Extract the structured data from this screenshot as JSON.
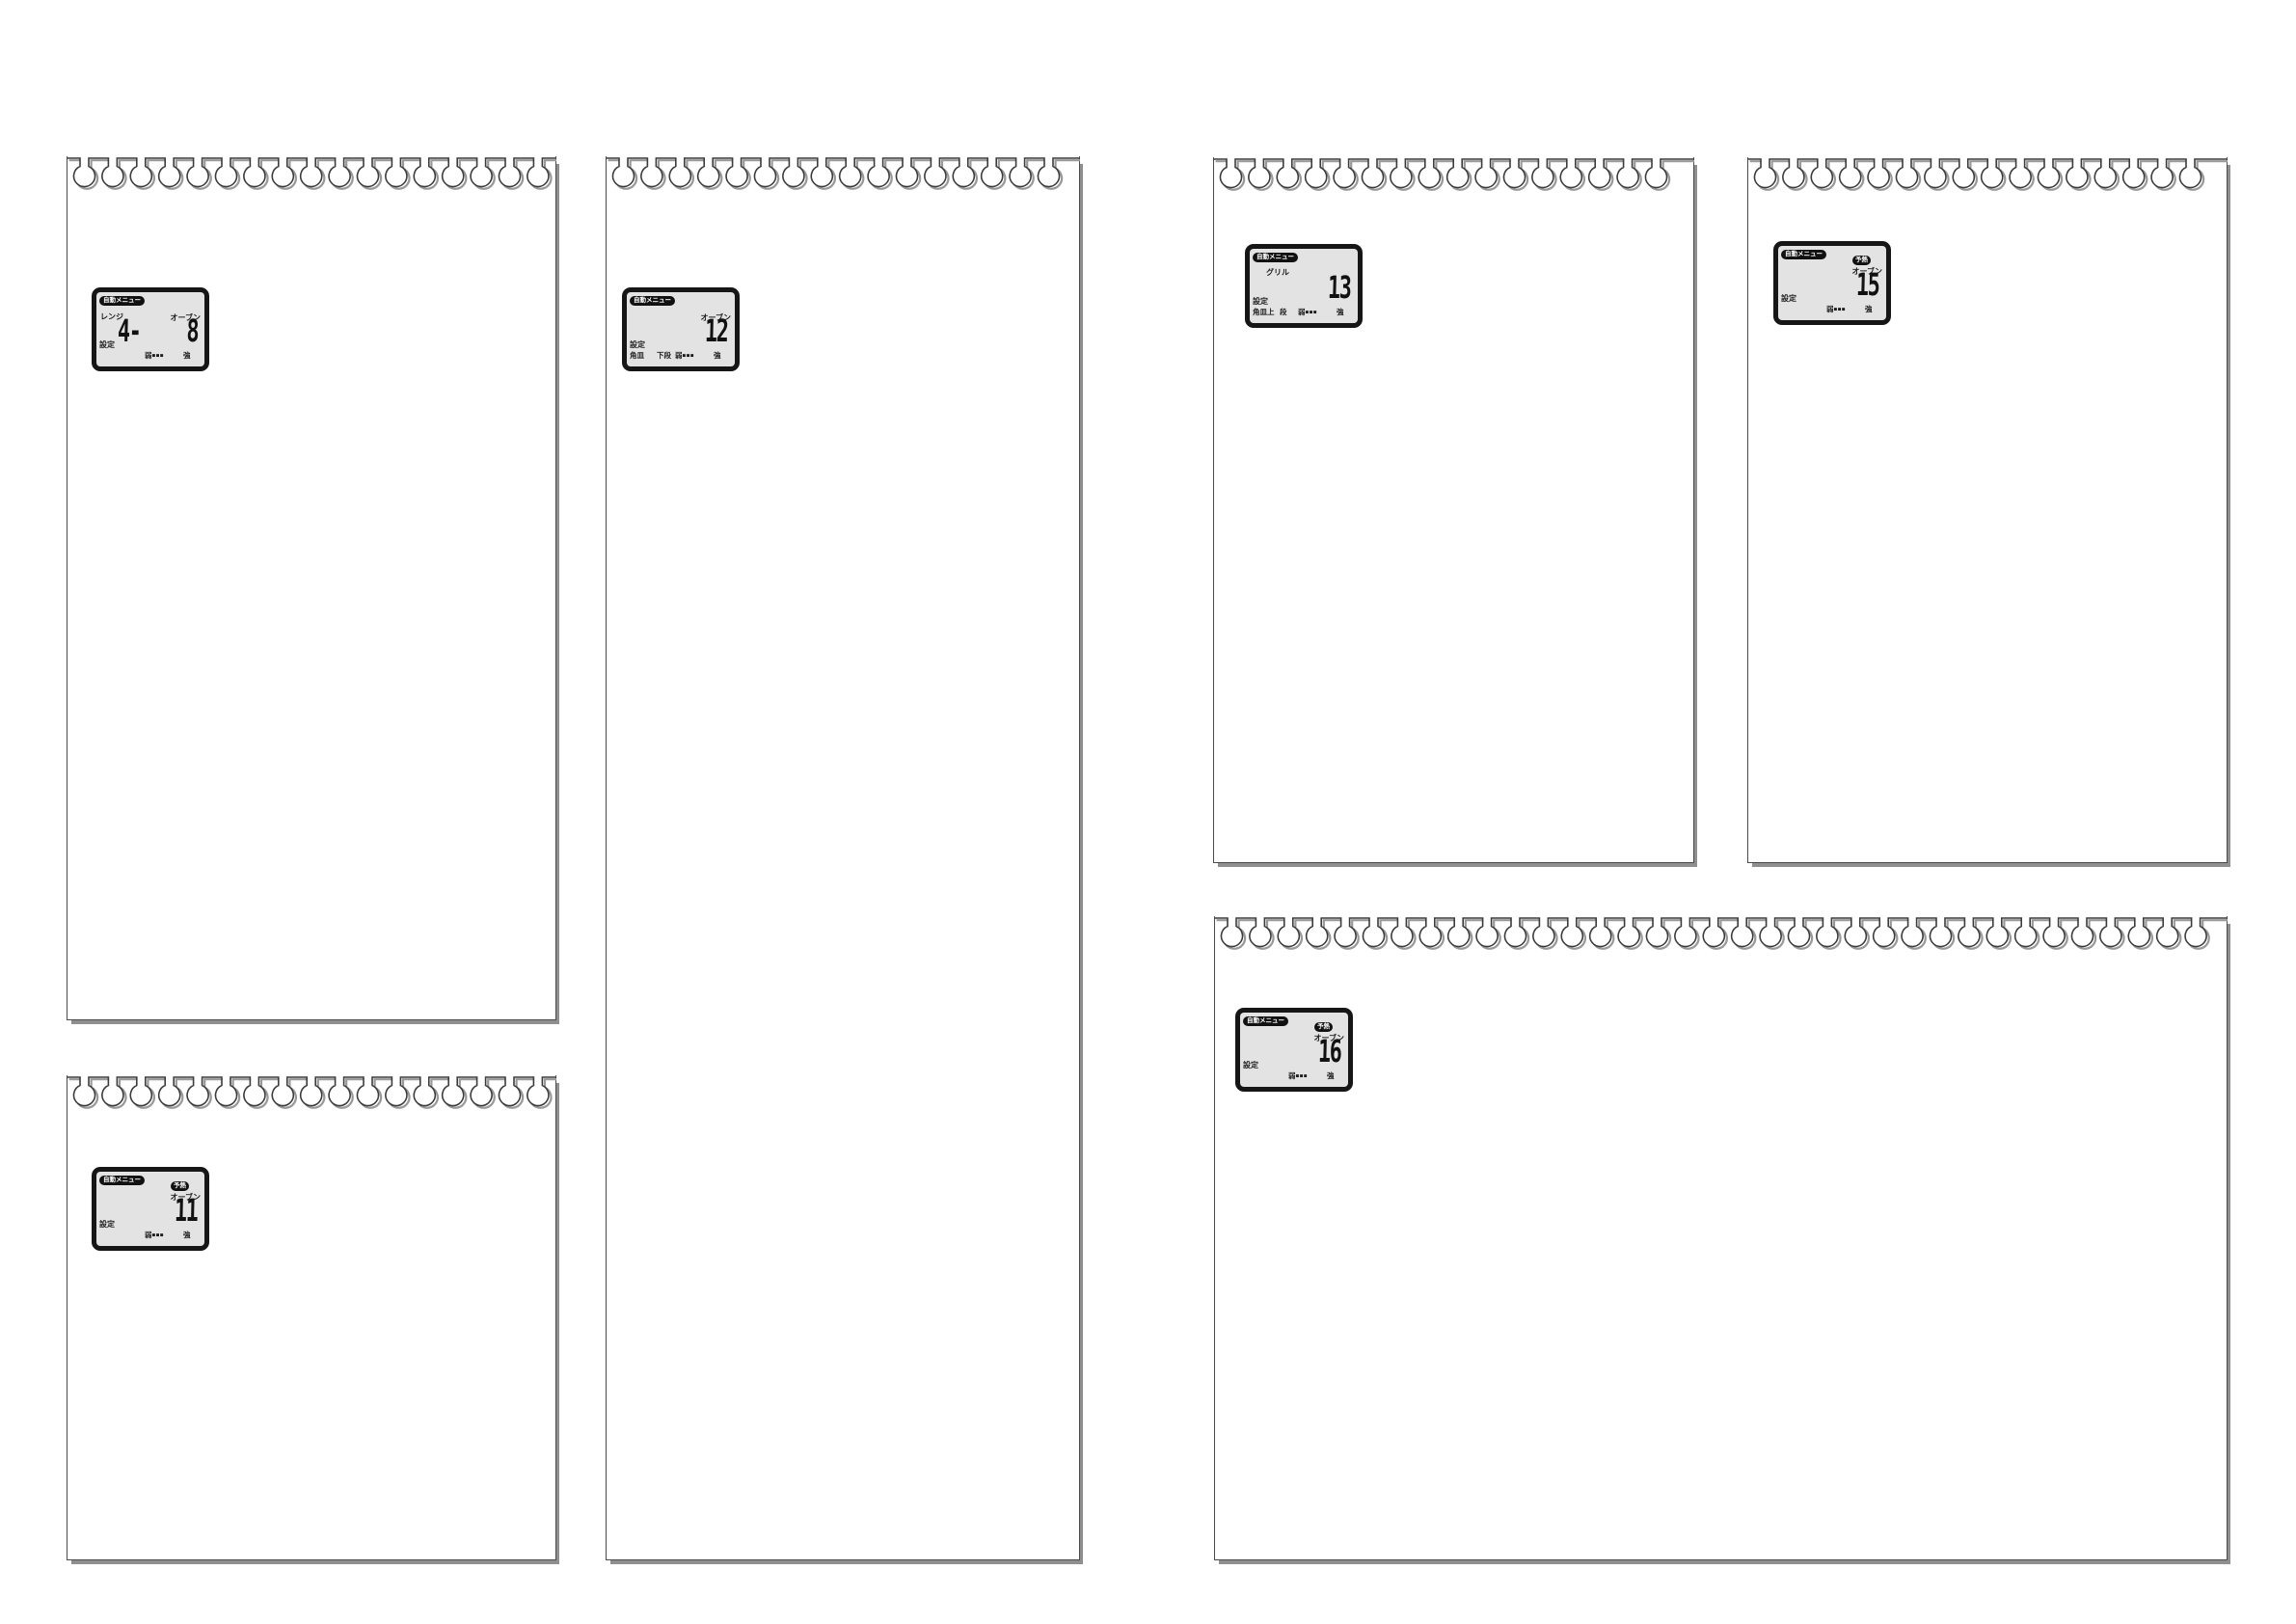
{
  "document": {
    "kind": "appliance-manual-page",
    "background": "#ffffff"
  },
  "colors": {
    "lcd_frame": "#161616",
    "lcd_screen": "#e3e3e3",
    "badge_bg": "#111111",
    "badge_fg": "#ffffff",
    "sheet_outline": "#4a4a4a",
    "sheet_shadow": "#8f8f8f"
  },
  "panels": [
    {
      "name": "notepad-range-oven",
      "lcd": {
        "badge": "自動メニュー",
        "mode_left": "レンジ",
        "mode_right": "オーブン",
        "digits_left": "4-",
        "digits": "8",
        "settei": "設定",
        "weak": "弱",
        "level": "■■■",
        "strong": "強"
      }
    },
    {
      "name": "notepad-oven-12",
      "lcd": {
        "badge": "自動メニュー",
        "mode_right": "オーブン",
        "digits": "12",
        "settei": "設定",
        "sub1": "角皿",
        "sub2": "下段",
        "weak": "弱",
        "level": "■■■",
        "strong": "強"
      }
    },
    {
      "name": "notepad-grill-13",
      "lcd": {
        "badge": "自動メニュー",
        "mode_left": "グリル",
        "digits": "13",
        "settei": "設定",
        "sub1": "角皿上",
        "sub2": "段",
        "weak": "弱",
        "level": "■■■",
        "strong": "強"
      }
    },
    {
      "name": "notepad-oven-preheat-15",
      "lcd": {
        "badge": "自動メニュー",
        "preheat": "予熱",
        "mode_right": "オーブン",
        "digits": "15",
        "settei": "設定",
        "weak": "弱",
        "level": "■■■",
        "strong": "強"
      }
    },
    {
      "name": "notepad-oven-preheat-11",
      "lcd": {
        "badge": "自動メニュー",
        "preheat": "予熱",
        "mode_right": "オーブン",
        "digits": "11",
        "settei": "設定",
        "weak": "弱",
        "level": "■■■",
        "strong": "強"
      }
    },
    {
      "name": "notepad-oven-preheat-16",
      "lcd": {
        "badge": "自動メニュー",
        "preheat": "予熱",
        "mode_right": "オーブン",
        "digits": "16",
        "settei": "設定",
        "weak": "弱",
        "level": "■■■",
        "strong": "強"
      }
    }
  ]
}
